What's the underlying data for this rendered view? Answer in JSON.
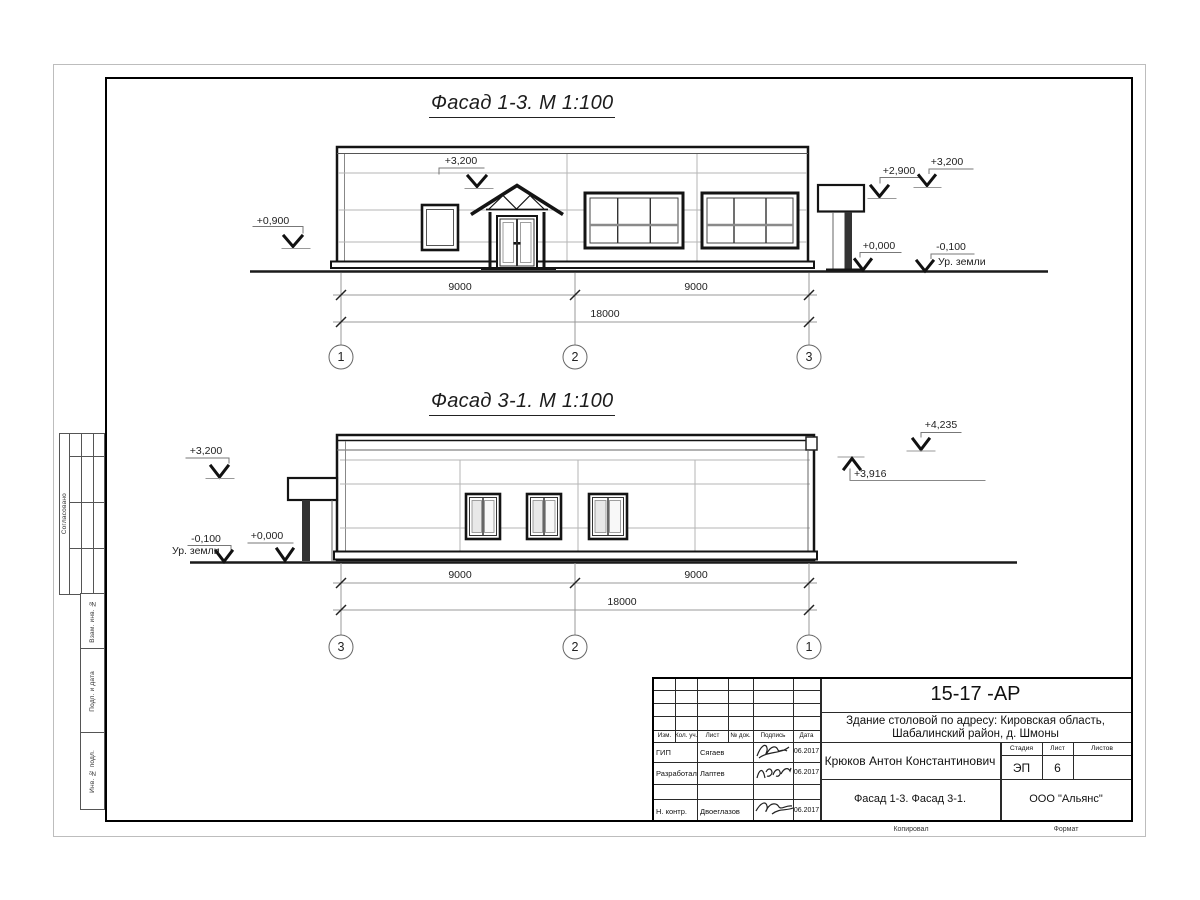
{
  "facade1": {
    "title": "Фасад 1-3.  М 1:100",
    "elev_0900": "+0,900",
    "elev_3200_mid": "+3,200",
    "elev_2900": "+2,900",
    "elev_3200_right": "+3,200",
    "elev_0000": "+0,000",
    "elev_minus_0100": "-0,100",
    "ground_label": "Ур. земли",
    "dim_left": "9000",
    "dim_right": "9000",
    "dim_total": "18000",
    "axis_left": "1",
    "axis_mid": "2",
    "axis_right": "3"
  },
  "facade2": {
    "title": "Фасад 3-1.  М 1:100",
    "elev_3200": "+3,200",
    "elev_minus_0100": "-0,100",
    "ground_label": "Ур. земли",
    "elev_0000": "+0,000",
    "elev_4235": "+4,235",
    "elev_3916": "+3,916",
    "dim_left": "9000",
    "dim_right": "9000",
    "dim_total": "18000",
    "axis_left": "3",
    "axis_mid": "2",
    "axis_right": "1"
  },
  "side_stamps": {
    "approved": "Согласовано",
    "vzam": "Взам. инв. №",
    "podp": "Подп. и дата",
    "inv": "Инв. № подл."
  },
  "title_block": {
    "doc_number": "15-17 -АР",
    "project_line1": "Здание столовой по адресу: Кировская область,",
    "project_line2": "Шабалинский район, д. Шмоны",
    "headers": {
      "izm": "Изм.",
      "kol": "Кол. уч.",
      "list": "Лист",
      "doc": "№ док.",
      "sign": "Подпись",
      "date": "Дата"
    },
    "rows": [
      {
        "role": "ГИП",
        "name": "Сягаев",
        "date": "06.2017"
      },
      {
        "role": "Разработал",
        "name": "Лаптев",
        "date": "06.2017"
      },
      {
        "role": "Н. контр.",
        "name": "Двоеглазов",
        "date": "06.2017"
      }
    ],
    "author": "Крюков Антон Константинович",
    "stage_label": "Стадия",
    "sheet_label": "Лист",
    "sheets_label": "Листов",
    "stage": "ЭП",
    "sheet_no": "6",
    "drawing_title": "Фасад 1-3. Фасад 3-1.",
    "company": "ООО \"Альянс\"",
    "copied": "Копировал",
    "format": "Формат"
  }
}
